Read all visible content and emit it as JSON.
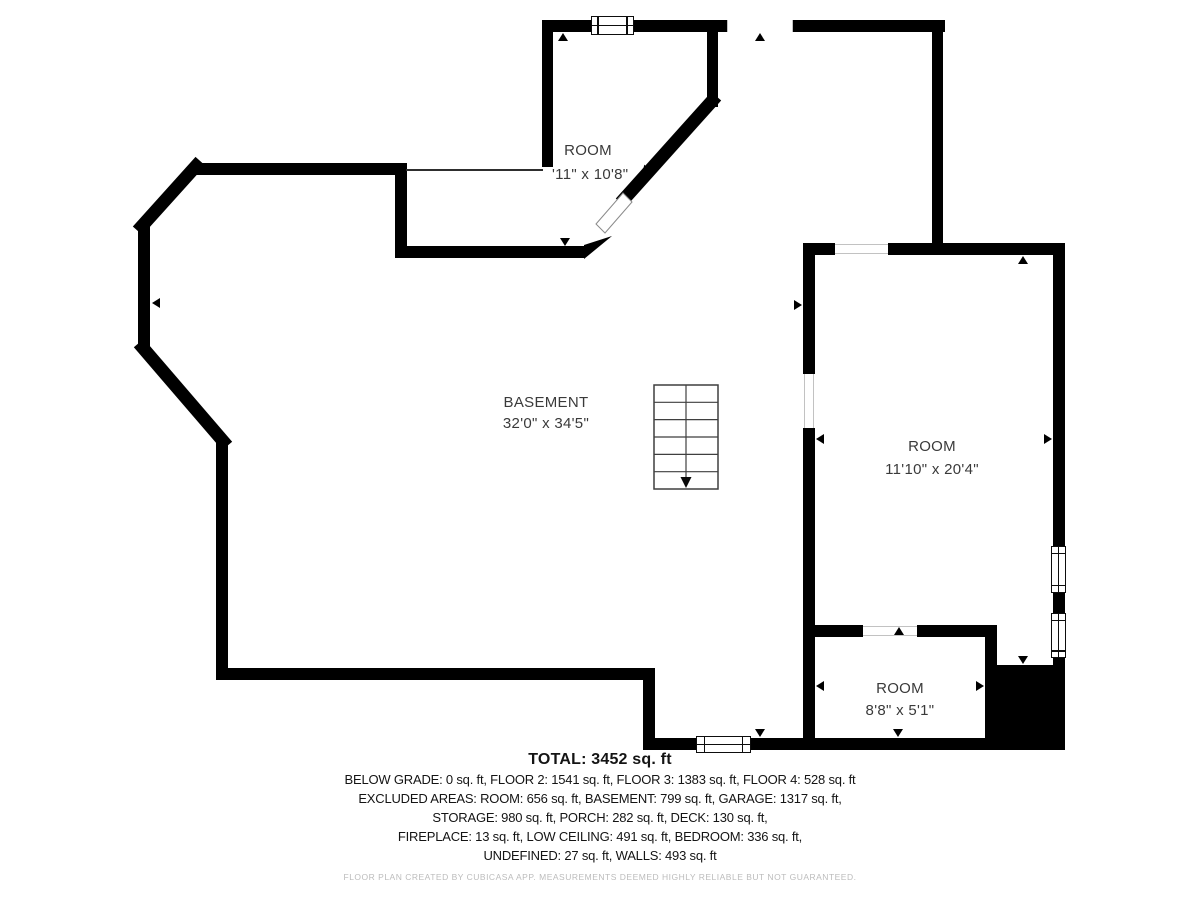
{
  "rooms": [
    {
      "name": "ROOM",
      "dims": "'11\" x 10'8\""
    },
    {
      "name": "BASEMENT",
      "dims": "32'0\" x 34'5\""
    },
    {
      "name": "ROOM",
      "dims": "11'10\" x 20'4\""
    },
    {
      "name": "ROOM",
      "dims": "8'8\" x 5'1\""
    }
  ],
  "summary": {
    "total": "TOTAL: 3452 sq. ft",
    "lines": [
      "BELOW GRADE: 0 sq. ft, FLOOR 2: 1541 sq. ft, FLOOR 3: 1383 sq. ft, FLOOR 4: 528 sq. ft",
      "EXCLUDED AREAS: ROOM: 656 sq. ft, BASEMENT: 799 sq. ft, GARAGE: 1317 sq. ft,",
      "STORAGE: 980 sq. ft, PORCH: 282 sq. ft, DECK: 130 sq. ft,",
      "FIREPLACE: 13 sq. ft, LOW CEILING: 491 sq. ft, BEDROOM: 336 sq. ft,",
      "UNDEFINED: 27 sq. ft, WALLS: 493 sq. ft"
    ]
  },
  "footer": "FLOOR PLAN CREATED BY CUBICASA APP. MEASUREMENTS DEEMED HIGHLY RELIABLE BUT NOT GUARANTEED.",
  "colors": {
    "wall": "#000000",
    "label": "#3a3a3a",
    "summary": "#141414",
    "footer": "#bcbcbc"
  }
}
